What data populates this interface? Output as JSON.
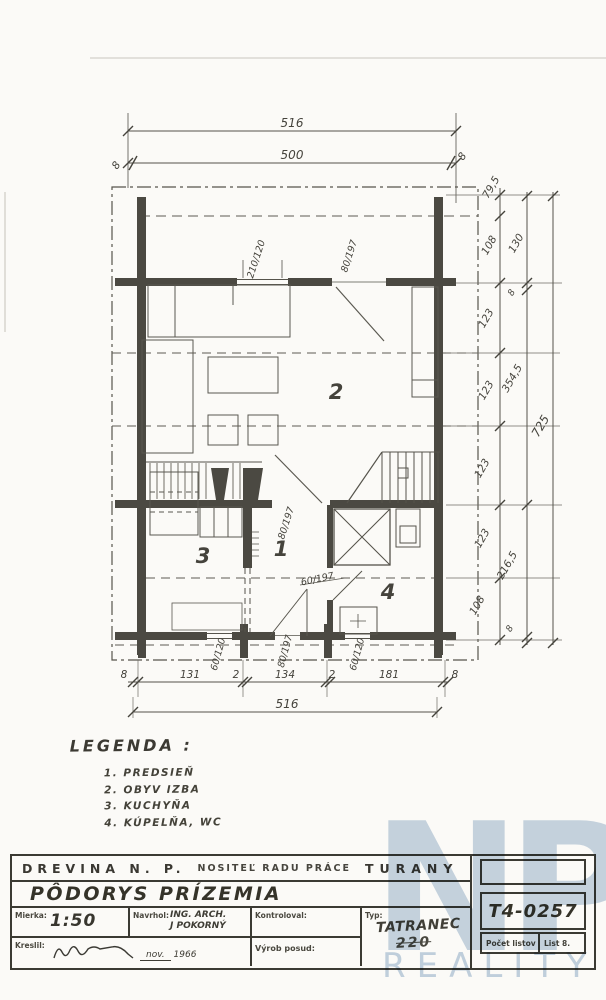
{
  "plan": {
    "top": {
      "total": "516",
      "inner": "500",
      "off_left": "8",
      "off_right": "8"
    },
    "right_inner": [
      "79,5",
      "108",
      "123",
      "123",
      "123",
      "123",
      "108"
    ],
    "right_mid": {
      "a": "130",
      "a8": "8",
      "b": "354,5",
      "c": "216,5",
      "c8": "8"
    },
    "right_total": "725",
    "openings": {
      "window_top": "210/120",
      "door_top": "80/197",
      "door_hall": "80/197",
      "door_bath": "60/197"
    },
    "bottom_fracs": [
      "60/120",
      "80/197",
      "60/120"
    ],
    "bottom_chain": [
      "8",
      "131",
      "2",
      "134",
      "2",
      "181",
      "8"
    ],
    "bottom_total": "516",
    "rooms": {
      "hall": "1",
      "living": "2",
      "kitchen": "3",
      "bath": "4"
    }
  },
  "legend": {
    "title": "LEGENDA :",
    "items": [
      "1. PREDSIEŇ",
      "2. OBYV IZBA",
      "3. KUCHYŇA",
      "4. KÚPELŇA, WC"
    ]
  },
  "titleblock": {
    "company": "DREVINA N. P.",
    "company2": "NOSITEĽ RADU PRÁCE",
    "company3": "TURANY",
    "drawing_title": "PÔDORYS PRÍZEMIA",
    "scale_label": "Mierka:",
    "scale": "1:50",
    "designed_label": "Navrhol:",
    "designed1": "ING. ARCH.",
    "designed2": "J POKORNÝ",
    "checked_label": "Kontroloval:",
    "type_label": "Typ:",
    "type_name": "TATRANEC",
    "type_num": "220",
    "code": "T4-0257",
    "drawn_label": "Kreslil:",
    "date_month": "nov.",
    "date_year": "1966",
    "vyrob_label": "Výrob posud:",
    "sheets_label": "Počet listov",
    "sheet_label": "List 8."
  },
  "watermark": {
    "letters": "NP",
    "text": "REALITY"
  }
}
